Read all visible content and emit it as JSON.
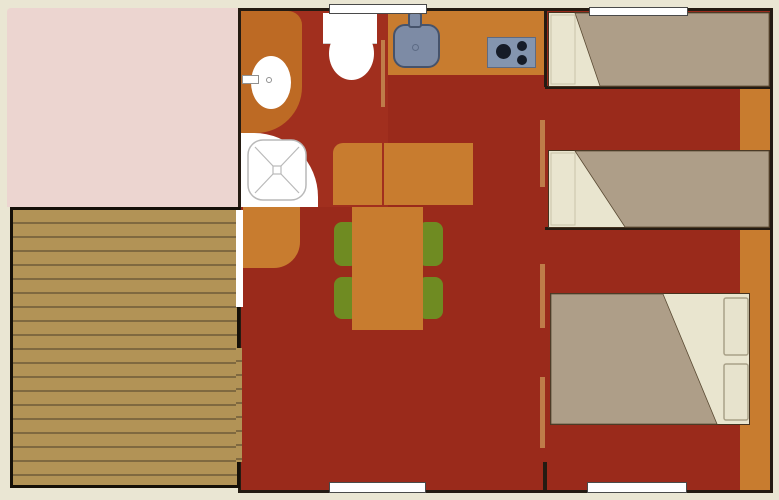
{
  "meta": {
    "type": "floorplan",
    "description": "Top-down floor plan of a mobile home / holiday cabin with annex room, wooden deck, bathroom, kitchen, dining area, twin bedroom and double bedroom",
    "width_px": 779,
    "height_px": 500,
    "visible_text": ""
  },
  "colors": {
    "bg": "#eae6d3",
    "annex": "#ecd5d0",
    "floor": "#9a2a1b",
    "floor-bath": "#a12f1e",
    "wall": "#241b12",
    "furniture": "#c87c2f",
    "vanity": "#bd6a24",
    "door": "#bf7c49",
    "chair": "#6f8b22",
    "sink": "#7d8ba5",
    "stove": "#8495af",
    "burner": "#161c28",
    "deck": "#b29356",
    "deck-stripe": "#7f6940",
    "deck-border": "#151008",
    "blanket": "#ae9e88",
    "sheet": "#e9e5cf",
    "pillow-outline": "#a9a188"
  },
  "areas": {
    "annex_room": "pink annex / awning room, top left",
    "wooden_deck": "striped wooden terrace, bottom left",
    "bathroom": {
      "fixtures": [
        "shower-tray",
        "washbasin",
        "toilet"
      ]
    },
    "kitchen": {
      "fixtures": [
        "kitchen-sink",
        "hob-3-burners"
      ]
    },
    "living_dining": {
      "furniture": [
        "sofa",
        "bench",
        "dining-table",
        "chairs-x4"
      ]
    },
    "twin_bedroom": {
      "furniture": [
        "single-bed-1",
        "single-bed-2"
      ]
    },
    "double_bedroom": {
      "furniture": [
        "double-bed-2-pillows",
        "wardrobe-strip"
      ]
    },
    "openings": {
      "windows": 4,
      "door_leaves": 4,
      "deck_doorway": 1
    }
  }
}
